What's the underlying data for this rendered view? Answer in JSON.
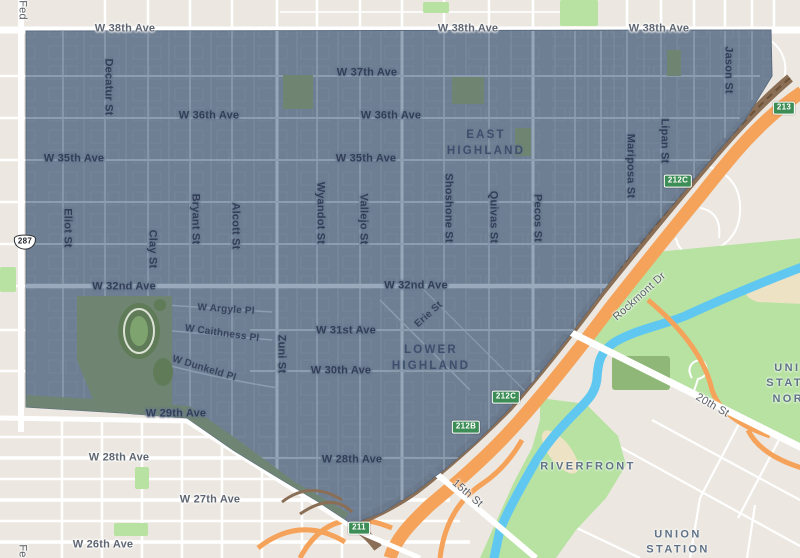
{
  "map": {
    "title": "Highland neighborhood map overlay",
    "overlay": {
      "name": "highland-neighborhood",
      "fill": "#68798E"
    },
    "colors": {
      "base": "#ECE8E1",
      "road_white": "#FFFFFF",
      "block_shade": "#E4E0D7",
      "overlay_fill": "#68798E",
      "overlay_street": "#8D9DB0",
      "park_bright": "#B7E2A2",
      "park_olive": "#8FB878",
      "park_muted": "#6F8571",
      "field_dark": "#5F7B58",
      "river": "#60C8F0",
      "sand": "#EDE2C4",
      "freeway_orange": "#F5A35A",
      "rail_brown": "#8A6E55",
      "rail_dark": "#6B5138",
      "shield_green": "#3D8E56",
      "label_dark": "#323E57",
      "label_gray": "#5E6672"
    },
    "labels": [
      {
        "t": "W 38th Ave",
        "k": "out",
        "x": 125,
        "y": 29
      },
      {
        "t": "W 38th Ave",
        "k": "out",
        "x": 468,
        "y": 29
      },
      {
        "t": "W 38th Ave",
        "k": "out",
        "x": 659,
        "y": 29
      },
      {
        "t": "W 37th Ave",
        "k": "ave",
        "x": 367,
        "y": 73
      },
      {
        "t": "W 36th Ave",
        "k": "ave",
        "x": 209,
        "y": 116
      },
      {
        "t": "W 36th Ave",
        "k": "ave",
        "x": 391,
        "y": 116
      },
      {
        "t": "W 35th Ave",
        "k": "ave",
        "x": 74,
        "y": 159
      },
      {
        "t": "W 35th Ave",
        "k": "ave",
        "x": 366,
        "y": 159
      },
      {
        "t": "W 32nd Ave",
        "k": "ave",
        "x": 124,
        "y": 287
      },
      {
        "t": "W 32nd Ave",
        "k": "ave",
        "x": 416,
        "y": 286
      },
      {
        "t": "W Argyle Pl",
        "k": "pl",
        "x": 226,
        "y": 310,
        "r": 4
      },
      {
        "t": "W Caithness Pl",
        "k": "pl",
        "x": 222,
        "y": 334,
        "r": 8
      },
      {
        "t": "W Dunkeld Pl",
        "k": "pl",
        "x": 204,
        "y": 369,
        "r": 17
      },
      {
        "t": "W 31st Ave",
        "k": "ave",
        "x": 346,
        "y": 331
      },
      {
        "t": "W 30th Ave",
        "k": "ave",
        "x": 341,
        "y": 371
      },
      {
        "t": "W 29th Ave",
        "k": "ave",
        "x": 176,
        "y": 414
      },
      {
        "t": "W 28th Ave",
        "k": "out",
        "x": 119,
        "y": 458
      },
      {
        "t": "W 28th Ave",
        "k": "ave",
        "x": 352,
        "y": 460
      },
      {
        "t": "W 27th Ave",
        "k": "out",
        "x": 210,
        "y": 500
      },
      {
        "t": "W 26th Ave",
        "k": "out",
        "x": 103,
        "y": 545
      },
      {
        "t": "Erie St",
        "k": "pl",
        "x": 429,
        "y": 315,
        "r": -42
      },
      {
        "t": "Zuni St",
        "k": "vst",
        "x": 281,
        "y": 354,
        "r": 90
      },
      {
        "t": "Decatur St",
        "k": "vst",
        "x": 108,
        "y": 87,
        "r": 90
      },
      {
        "t": "Eliot St",
        "k": "vst",
        "x": 67,
        "y": 228,
        "r": 90
      },
      {
        "t": "Clay St",
        "k": "vst",
        "x": 152,
        "y": 249,
        "r": 90
      },
      {
        "t": "Bryant St",
        "k": "vst",
        "x": 195,
        "y": 219,
        "r": 90
      },
      {
        "t": "Alcott St",
        "k": "vst",
        "x": 235,
        "y": 226,
        "r": 90
      },
      {
        "t": "Wyandot St",
        "k": "vst",
        "x": 320,
        "y": 213,
        "r": 90
      },
      {
        "t": "Vallejo St",
        "k": "vst",
        "x": 363,
        "y": 219,
        "r": 90
      },
      {
        "t": "Shoshone St",
        "k": "vst",
        "x": 448,
        "y": 208,
        "r": 90
      },
      {
        "t": "Quivas St",
        "k": "vst",
        "x": 493,
        "y": 217,
        "r": 90
      },
      {
        "t": "Pecos St",
        "k": "vst",
        "x": 537,
        "y": 218,
        "r": 90
      },
      {
        "t": "Mariposa St",
        "k": "vst",
        "x": 630,
        "y": 166,
        "r": 90
      },
      {
        "t": "Lipan St",
        "k": "vst",
        "x": 664,
        "y": 141,
        "r": 90
      },
      {
        "t": "Jason St",
        "k": "vst",
        "x": 728,
        "y": 70,
        "r": 90
      },
      {
        "t": "Rockmont Dr",
        "k": "road",
        "x": 640,
        "y": 297,
        "r": -42
      },
      {
        "t": "20th St",
        "k": "road",
        "x": 712,
        "y": 406,
        "r": 30
      },
      {
        "t": "15th St",
        "k": "road",
        "x": 467,
        "y": 494,
        "r": 41
      },
      {
        "t": "Fed",
        "k": "road",
        "x": 22,
        "y": 10,
        "r": 90
      },
      {
        "t": "Fe",
        "k": "road",
        "x": 22,
        "y": 551,
        "r": 90
      },
      {
        "t": "EAST\nHIGHLAND",
        "k": "dist",
        "x": 486,
        "y": 143
      },
      {
        "t": "LOWER\nHIGHLAND",
        "k": "dist",
        "x": 431,
        "y": 358
      },
      {
        "t": "RIVERFRONT",
        "k": "dist2",
        "x": 588,
        "y": 467
      },
      {
        "t": "UNION STATION\nNORTH",
        "k": "dist2",
        "x": 798,
        "y": 384
      },
      {
        "t": "UNION\nSTATION",
        "k": "dist2",
        "x": 678,
        "y": 543
      }
    ],
    "shields": [
      {
        "label": "287",
        "type": "us",
        "x": 25,
        "y": 242
      },
      {
        "label": "213",
        "type": "green",
        "x": 784,
        "y": 108
      },
      {
        "label": "212C",
        "type": "green",
        "x": 678,
        "y": 181
      },
      {
        "label": "212C",
        "type": "green",
        "x": 506,
        "y": 397
      },
      {
        "label": "212B",
        "type": "green",
        "x": 466,
        "y": 427
      },
      {
        "label": "211",
        "type": "green",
        "x": 359,
        "y": 528
      }
    ]
  }
}
